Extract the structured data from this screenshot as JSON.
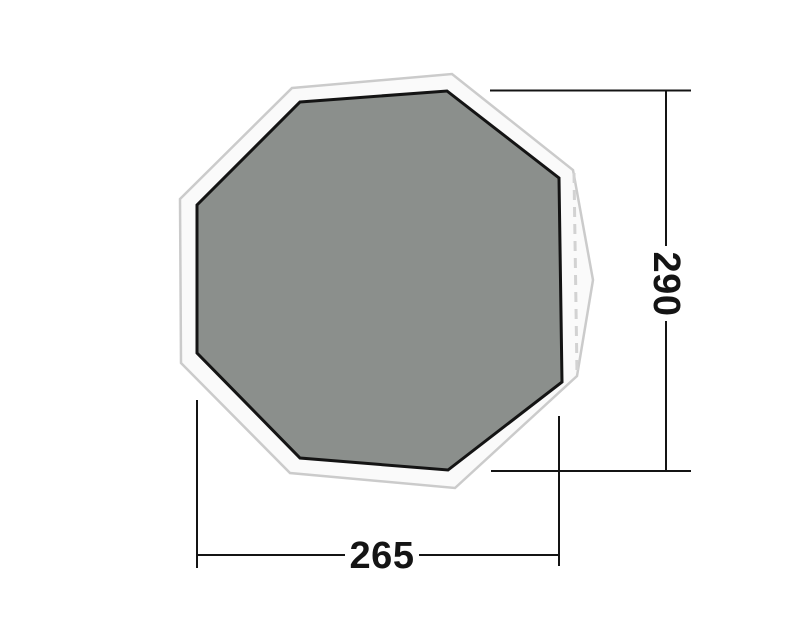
{
  "diagram": {
    "type": "footprint-dimension-drawing",
    "view": "top-view-octagonal-groundsheet",
    "dimension_width": "265",
    "dimension_height": "290",
    "colors": {
      "groundsheet_fill": "#8b8f8c",
      "groundsheet_border": "#141414",
      "footprint_fill": "#fafafa",
      "footprint_outline": "#cbcbcb",
      "dashed_edge": "#d2d2d2",
      "dimension_line": "#141414",
      "label_text": "#141414",
      "background": "#ffffff"
    }
  }
}
